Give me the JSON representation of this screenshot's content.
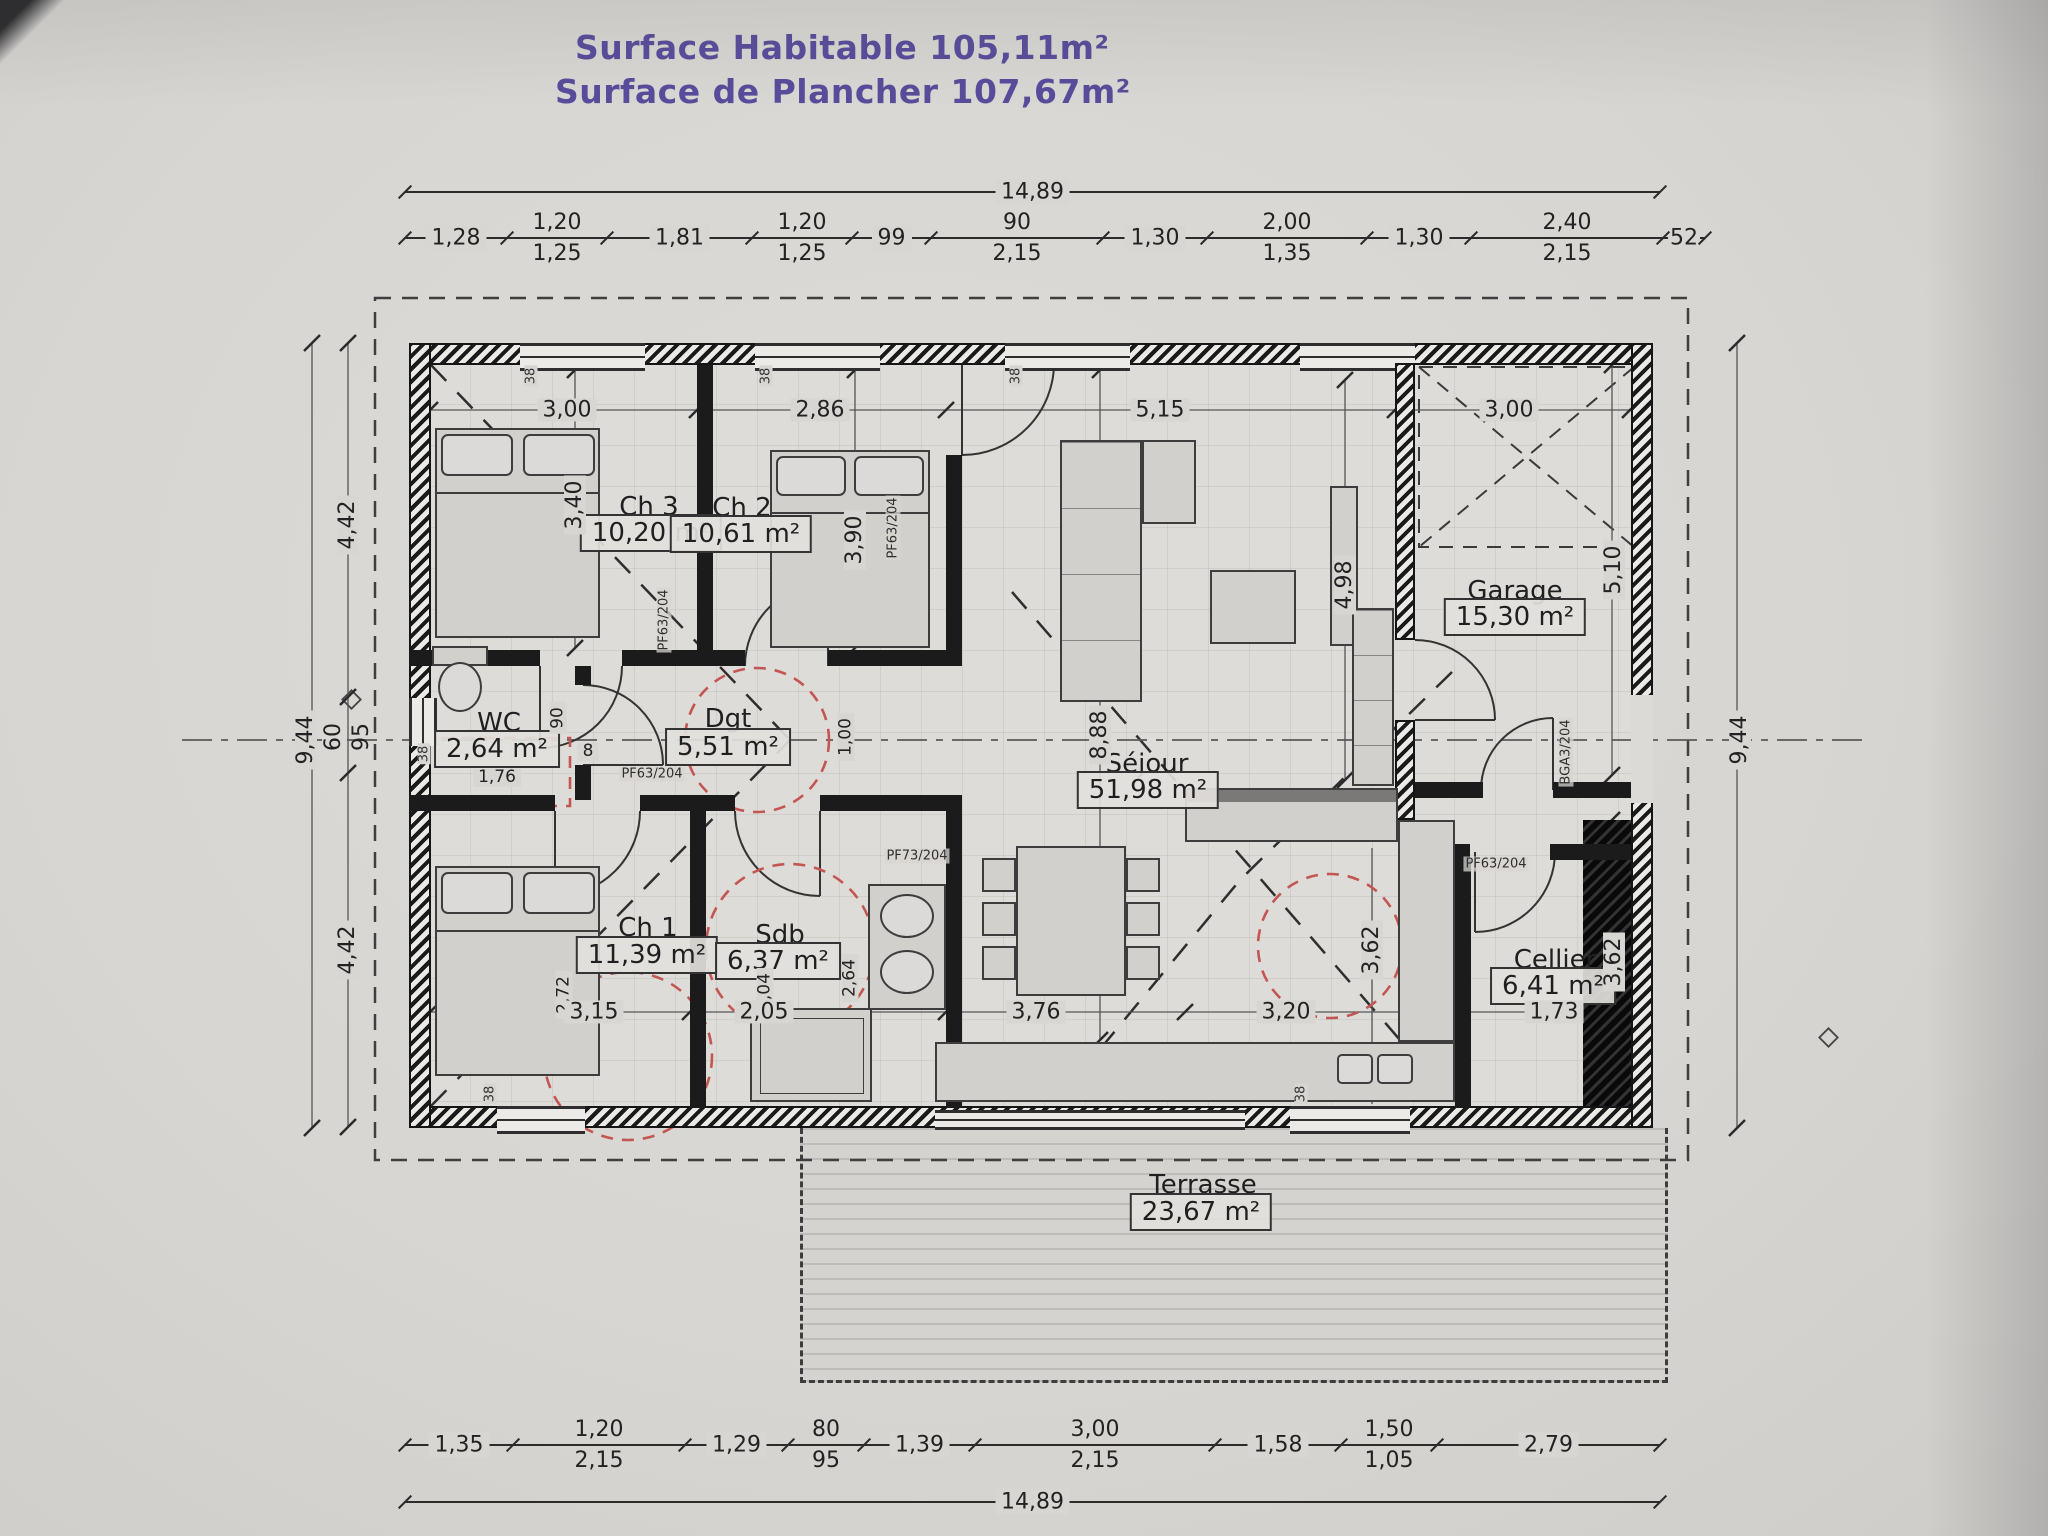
{
  "title": {
    "line1": "Surface Habitable 105,11m²",
    "line2": "Surface de Plancher 107,67m²"
  },
  "rooms": {
    "ch3": {
      "name": "Ch 3",
      "area": "10,20 m²"
    },
    "ch2": {
      "name": "Ch 2",
      "area": "10,61 m²"
    },
    "garage": {
      "name": "Garage",
      "area": "15,30 m²"
    },
    "wc": {
      "name": "WC",
      "area": "2,64 m²"
    },
    "dgt": {
      "name": "Dgt",
      "area": "5,51 m²"
    },
    "sejour": {
      "name": "Séjour",
      "area": "51,98 m²"
    },
    "ch1": {
      "name": "Ch 1",
      "area": "11,39 m²"
    },
    "sdb": {
      "name": "Sdb",
      "area": "6,37 m²"
    },
    "cellier": {
      "name": "Cellier",
      "area": "6,41 m²"
    },
    "terrasse": {
      "name": "Terrasse",
      "area": "23,67 m²"
    }
  },
  "dims": {
    "total_width": "14,89",
    "total_height": "9,44",
    "top_chain": [
      {
        "a": "1,28"
      },
      {
        "a": "1,20",
        "b": "1,25"
      },
      {
        "a": "1,81"
      },
      {
        "a": "1,20",
        "b": "1,25"
      },
      {
        "a": "99"
      },
      {
        "a": "90",
        "b": "2,15"
      },
      {
        "a": "1,30"
      },
      {
        "a": "2,00",
        "b": "1,35"
      },
      {
        "a": "1,30"
      },
      {
        "a": "2,40",
        "b": "2,15"
      },
      {
        "a": "52"
      }
    ],
    "bottom_chain": [
      {
        "a": "1,35"
      },
      {
        "a": "1,20",
        "b": "2,15"
      },
      {
        "a": "1,29"
      },
      {
        "a": "80",
        "b": "95"
      },
      {
        "a": "1,39"
      },
      {
        "a": "3,00",
        "b": "2,15"
      },
      {
        "a": "1,58"
      },
      {
        "a": "1,50",
        "b": "1,05"
      },
      {
        "a": "2,79"
      }
    ],
    "left_chain": [
      {
        "a": "4,42"
      },
      {
        "a": "60",
        "b": "95"
      },
      {
        "a": "4,42"
      }
    ],
    "interior": {
      "w_ch3": "3,00",
      "w_ch2": "2,86",
      "w_sejour": "5,15",
      "w_garage": "3,00",
      "h_ch3": "3,40",
      "h_ch2": "3,90",
      "h_sejour": "8,88",
      "h_kitchen": "4,98",
      "h_garage": "5,10",
      "hall_w": "1,00",
      "wc_door": "90",
      "wc_w": "1,76",
      "wc_jamb": "8",
      "ch1_h": "2,72",
      "ch1_w": "3,15",
      "sdb_w": "2,05",
      "sdb_h": "2,04",
      "sdb_wc": "2,64",
      "dining_w": "3,76",
      "kitchen_w": "3,20",
      "kitchen_h": "3,62",
      "cellier_w": "1,73",
      "cellier_h": "3,62",
      "jamb": "38"
    }
  },
  "openings": {
    "pf63": "PF63/204",
    "pf73": "PF73/204",
    "entry": "BGA3/204"
  }
}
